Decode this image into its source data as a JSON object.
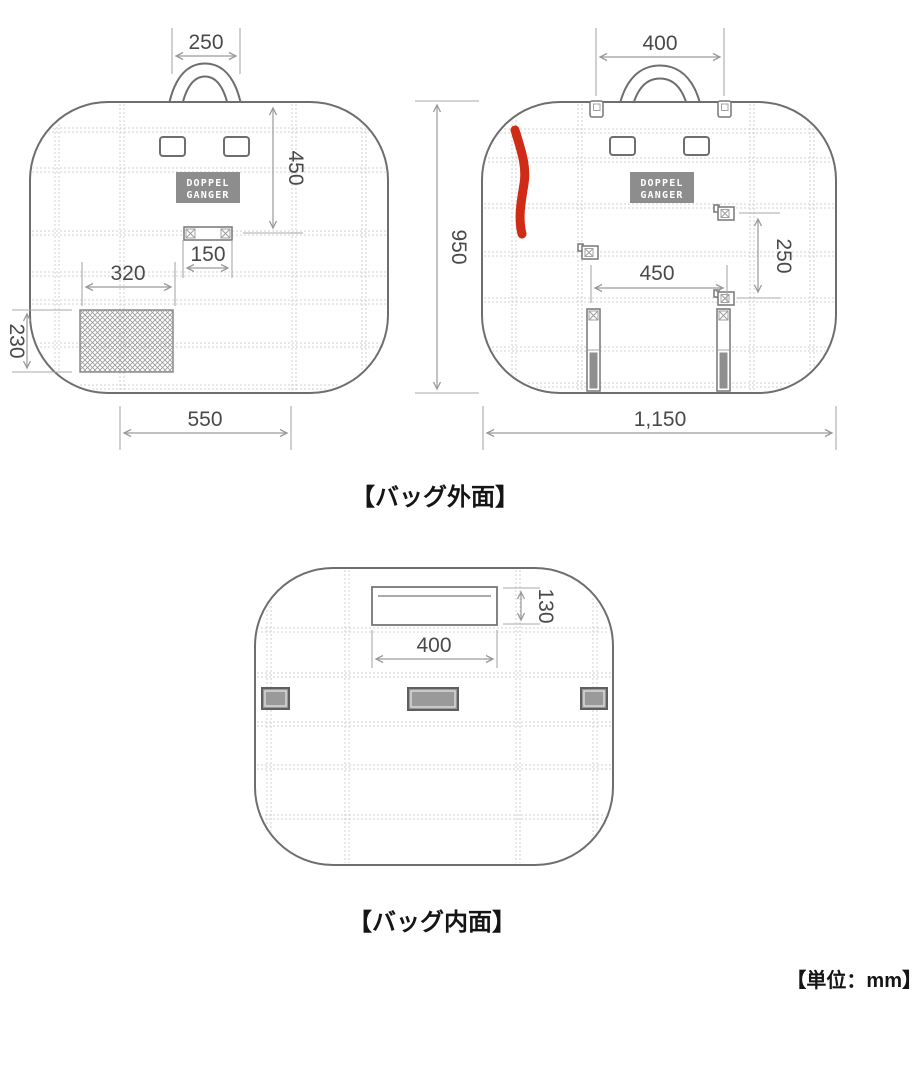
{
  "captions": {
    "exterior": "【バッグ外面】",
    "interior": "【バッグ内面】",
    "unit": "【単位：mm】"
  },
  "logo": {
    "line1": "DOPPEL",
    "line2": "GANGER"
  },
  "exterior_front": {
    "handle_width": "250",
    "top_to_strap": "450",
    "strap_width": "150",
    "mesh_pocket_width": "320",
    "mesh_pocket_height": "230",
    "bottom_width": "550"
  },
  "exterior_back": {
    "handle_width": "400",
    "height": "950",
    "buckle_spacing_vertical": "250",
    "buckle_spacing_horizontal": "450",
    "bottom_width": "1,150"
  },
  "interior": {
    "pocket_height": "130",
    "pocket_width": "400"
  },
  "colors": {
    "outline": "#6e6e6e",
    "dimension_lines": "#9a9a9a",
    "dimension_text": "#4a4a4a",
    "caption_text": "#151515",
    "logo_fill": "#8d8d8d",
    "quilt_stitch": "#d2d2d2",
    "annotation_red": "#cf2b16",
    "tab_fill": "#9a9a9a"
  }
}
